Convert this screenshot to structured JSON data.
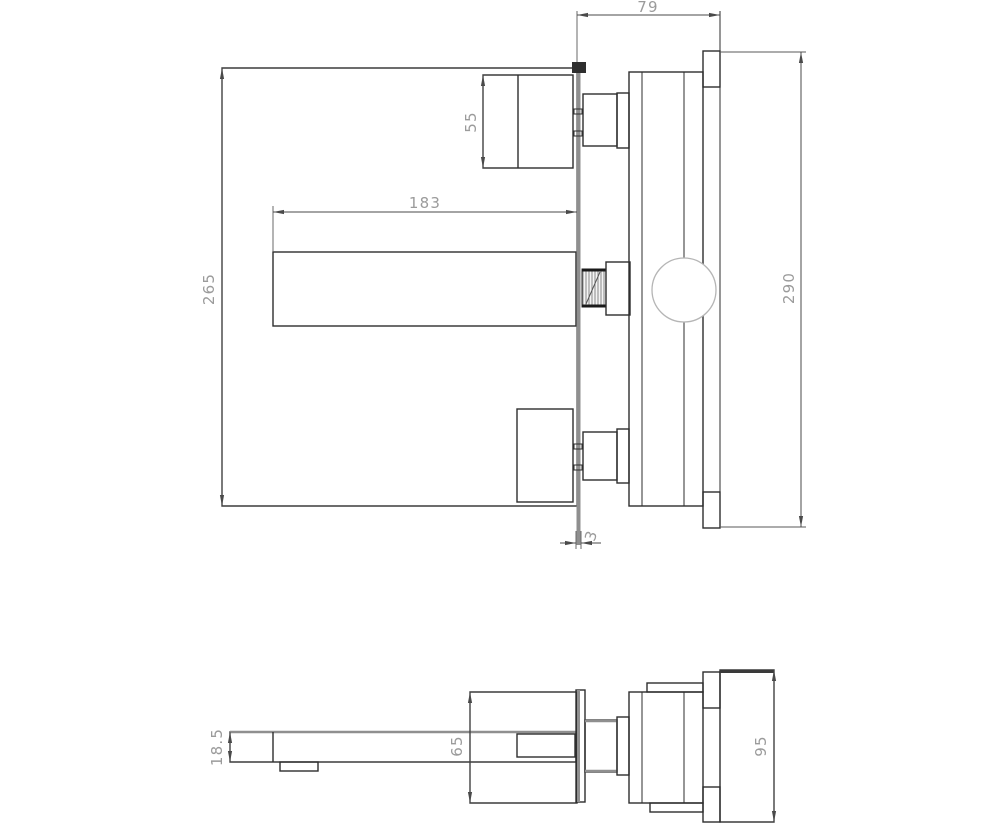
{
  "document": {
    "type": "technical drawing",
    "subject": "wall-mounted basin mixer faucet installation drawing",
    "background": "#ffffff"
  },
  "colors": {
    "outline": "#2e2e2e",
    "thick_gray": "#8f8f8f",
    "dim_text": "#9b9b9b",
    "dim_line": "#4a4a4a",
    "cartridge_circle": "#b5b5b5"
  },
  "side_view": {
    "name": "side elevation",
    "dims": {
      "depth_behind_wall": "79",
      "handle_height": "55",
      "spout_length": "183",
      "front_height": "265",
      "concealed_plate_height": "290",
      "wall_plate_thickness": "3"
    }
  },
  "plan_view": {
    "name": "top view",
    "dims": {
      "spout_width": "18.5",
      "valve_body_width": "65",
      "concealed_plate_width": "95"
    }
  }
}
